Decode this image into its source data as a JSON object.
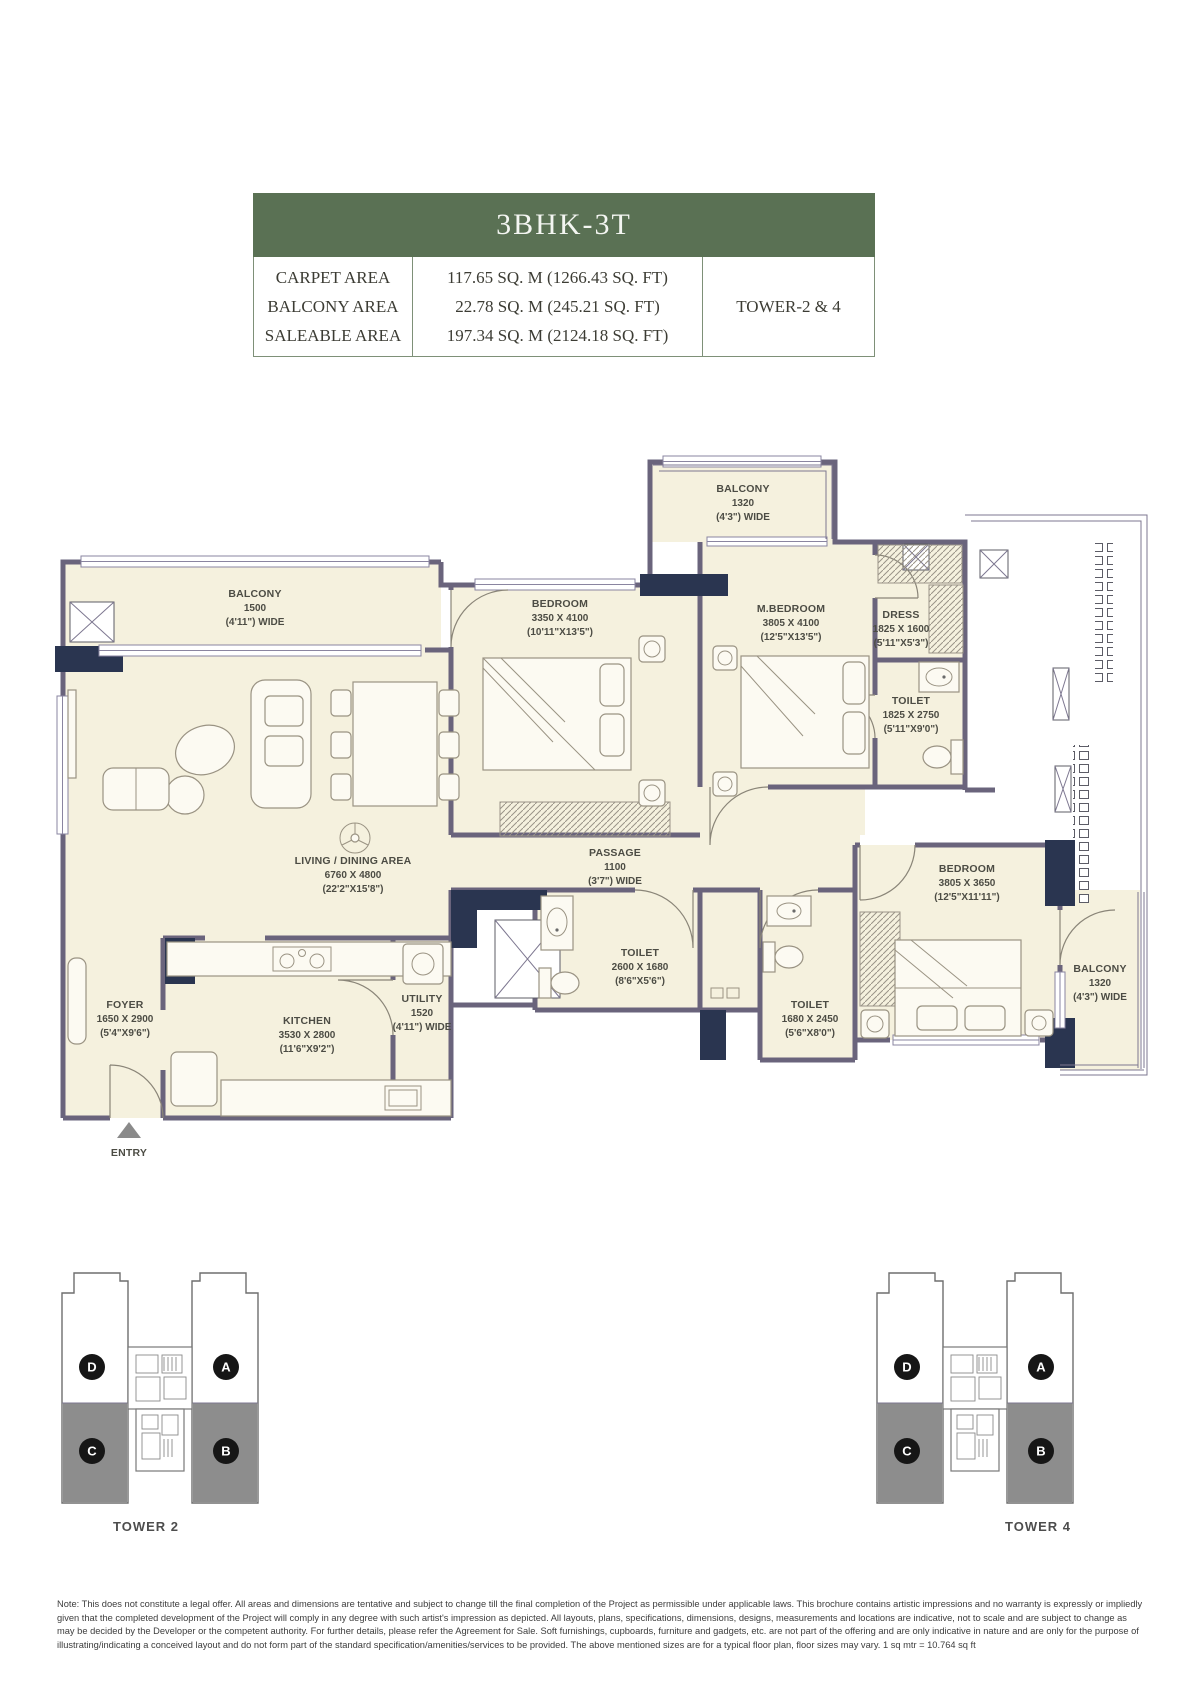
{
  "colors": {
    "header_green": "#5a7154",
    "table_border_green": "#7e9078",
    "floor_cream": "#f5f1de",
    "wall_gray": "#6a647c",
    "wall_navy": "#2a3550",
    "tower_unit_gray": "#8d8d8d"
  },
  "spec": {
    "title": "3BHK-3T",
    "rows": [
      {
        "label": "CARPET AREA",
        "value": "117.65 SQ. M (1266.43 SQ. FT)"
      },
      {
        "label": "BALCONY AREA",
        "value": "22.78 SQ. M (245.21 SQ. FT)"
      },
      {
        "label": "SALEABLE AREA",
        "value": "197.34 SQ. M (2124.18 SQ. FT)"
      }
    ],
    "tower": "TOWER-2 & 4"
  },
  "floorplan": {
    "entry_label": "ENTRY",
    "rooms": {
      "balcony_left": {
        "name": "BALCONY",
        "l1": "1500",
        "l2": "(4'11\") WIDE"
      },
      "living": {
        "name": "LIVING / DINING AREA",
        "l1": "6760 X 4800",
        "l2": "(22'2\"X15'8\")"
      },
      "foyer": {
        "name": "FOYER",
        "l1": "1650 X 2900",
        "l2": "(5'4\"X9'6\")"
      },
      "kitchen": {
        "name": "KITCHEN",
        "l1": "3530 X 2800",
        "l2": "(11'6\"X9'2\")"
      },
      "utility": {
        "name": "UTILITY",
        "l1": "1520",
        "l2": "(4'11\") WIDE"
      },
      "bedroom_top": {
        "name": "BEDROOM",
        "l1": "3350 X 4100",
        "l2": "(10'11\"X13'5\")"
      },
      "balcony_top": {
        "name": "BALCONY",
        "l1": "1320",
        "l2": "(4'3\") WIDE"
      },
      "mbedroom": {
        "name": "M.BEDROOM",
        "l1": "3805 X 4100",
        "l2": "(12'5\"X13'5\")"
      },
      "dress": {
        "name": "DRESS",
        "l1": "1825 X 1600",
        "l2": "(5'11\"X5'3\")"
      },
      "toilet_master": {
        "name": "TOILET",
        "l1": "1825 X 2750",
        "l2": "(5'11\"X9'0\")"
      },
      "passage": {
        "name": "PASSAGE",
        "l1": "1100",
        "l2": "(3'7\") WIDE"
      },
      "toilet_common": {
        "name": "TOILET",
        "l1": "2600 X 1680",
        "l2": "(8'6\"X5'6\")"
      },
      "toilet_bed3": {
        "name": "TOILET",
        "l1": "1680 X 2450",
        "l2": "(5'6\"X8'0\")"
      },
      "bedroom_br": {
        "name": "BEDROOM",
        "l1": "3805 X 3650",
        "l2": "(12'5\"X11'11\")"
      },
      "balcony_right": {
        "name": "BALCONY",
        "l1": "1320",
        "l2": "(4'3\") WIDE"
      }
    }
  },
  "towers": {
    "tower2": {
      "caption": "TOWER 2",
      "units": {
        "d": "D",
        "a": "A",
        "c": "C",
        "b": "B"
      }
    },
    "tower4": {
      "caption": "TOWER 4",
      "units": {
        "d": "D",
        "a": "A",
        "c": "C",
        "b": "B"
      }
    }
  },
  "note": {
    "text": "Note: This does not constitute a legal offer. All areas and dimensions are tentative and subject to change till the final completion of the Project as permissible under applicable laws. This brochure contains artistic impressions and no warranty is expressly or impliedly given that the completed development of the Project will comply in any degree with such artist's impression as depicted. All layouts, plans, specifications, dimensions, designs, measurements and locations are indicative, not to scale and are subject to change as may be decided by the Developer or the competent authority. For further details, please refer the Agreement for Sale. Soft furnishings, cupboards, furniture and gadgets, etc. are not part of the offering and are only indicative in nature and are only for the purpose of illustrating/indicating a conceived layout and do not form part of the standard specification/amenities/services to be provided. The above mentioned sizes are for a typical floor plan, floor sizes may vary. 1 sq mtr = 10.764 sq ft"
  }
}
